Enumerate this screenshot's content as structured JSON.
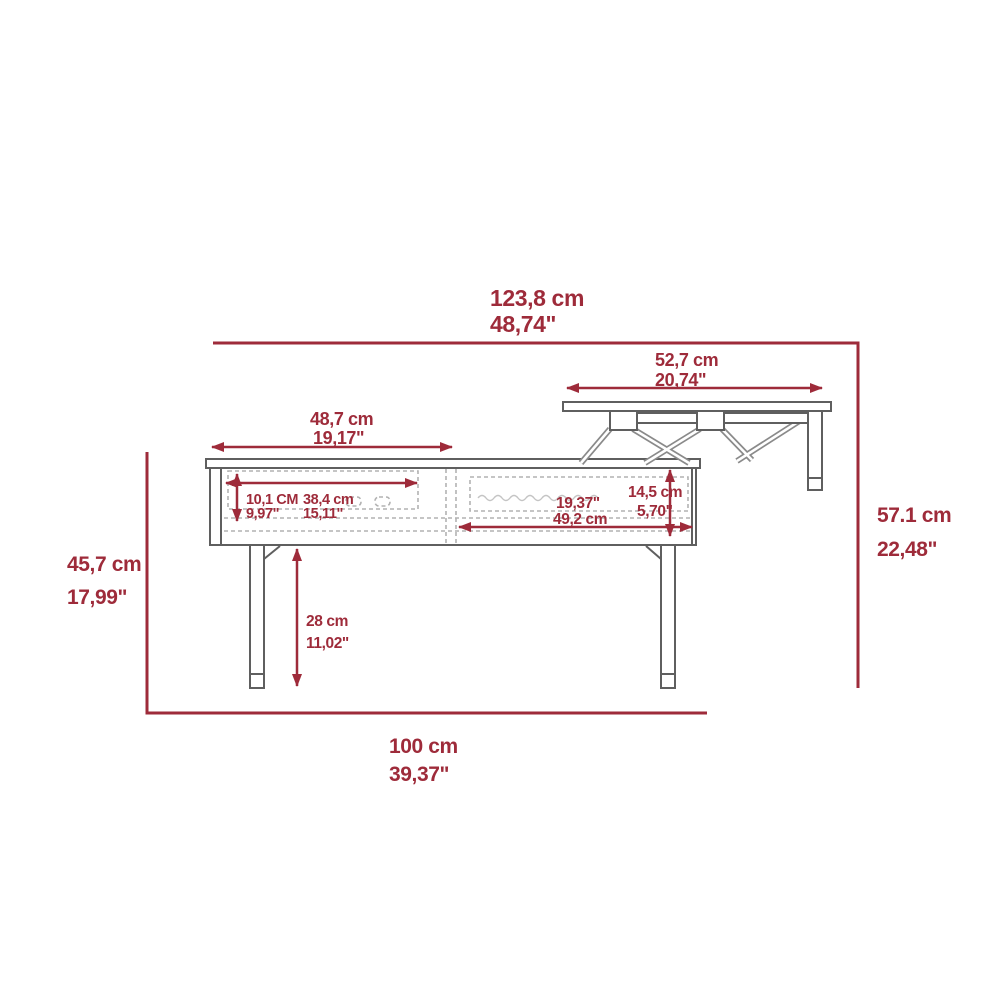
{
  "meta": {
    "description": "Technical dimension drawing of a lift-top coffee table, side view, top shown raised"
  },
  "colors": {
    "dimension_red": "#9e2b3a",
    "furniture_gray": "#5f5f5f",
    "dashed_gray": "#b2b2b2",
    "background": "#ffffff"
  },
  "dimensions": {
    "overall_width": {
      "cm": "123,8 cm",
      "in": "48,74\""
    },
    "lifted_top_width": {
      "cm": "52,7 cm",
      "in": "20,74\""
    },
    "fixed_top_width": {
      "cm": "48,7 cm",
      "in": "19,17\""
    },
    "body_height": {
      "cm": "45,7 cm",
      "in": "17,99\""
    },
    "overall_height": {
      "cm": "57.1 cm",
      "in": "22,48\""
    },
    "base_width": {
      "cm": "100 cm",
      "in": "39,37\""
    },
    "drawer_height": {
      "cm": "10,1 CM",
      "in": "9,97\""
    },
    "drawer_width": {
      "cm": "38,4 cm",
      "in": "15,11\""
    },
    "storage_width": {
      "in": "19,37\"",
      "cm": "49,2 cm"
    },
    "storage_height": {
      "cm": "14,5 cm",
      "in": "5,70\""
    },
    "leg_clearance": {
      "cm": "28 cm",
      "in": "11,02\""
    }
  }
}
